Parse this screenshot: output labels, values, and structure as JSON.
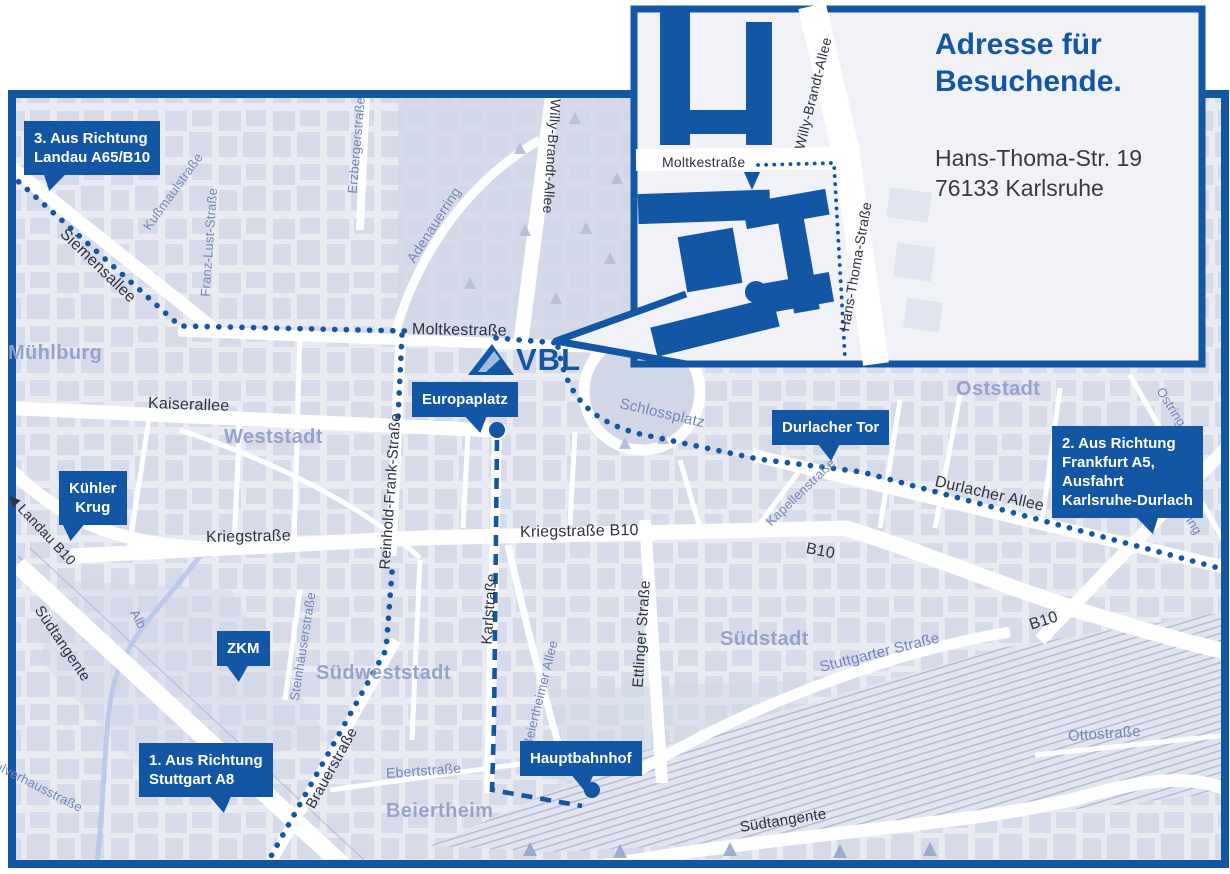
{
  "colors": {
    "primary_blue": "#1356a4",
    "map_bg": "#e9ebf3",
    "block": "#d6dae9",
    "road": "#ffffff",
    "district_text": "#93a0ca",
    "street_dark": "#2e3340",
    "street_minor": "#7386ba",
    "rail": "#a9b2d2",
    "river": "#b9c7e7",
    "park": "#d2d7e8",
    "logo_stripe": "#9dbede",
    "text_dark": "#3a3a3a",
    "inset_bg": "#f1f2f7"
  },
  "inset": {
    "title_line1": "Adresse für",
    "title_line2": "Besuchende.",
    "address_line1": "Hans-Thoma-Str. 19",
    "address_line2": "76133 Karlsruhe"
  },
  "logo": {
    "text": "VBL"
  },
  "map": {
    "street_labels": [
      {
        "id": "siemensallee",
        "text": "Siemensallee",
        "x": 62,
        "y": 232,
        "rot": 44,
        "size": 16,
        "minor": false
      },
      {
        "id": "moltkestrasse",
        "text": "Moltkestraße",
        "x": 412,
        "y": 330,
        "rot": 1,
        "size": 16,
        "minor": false
      },
      {
        "id": "kaiserallee",
        "text": "Kaiserallee",
        "x": 148,
        "y": 404,
        "rot": 2,
        "size": 16,
        "minor": false
      },
      {
        "id": "kriegstrasse",
        "text": "Kriegstraße",
        "x": 206,
        "y": 538,
        "rot": -1,
        "size": 16,
        "minor": false
      },
      {
        "id": "kriegstrasse-b10",
        "text": "Kriegstraße B10",
        "x": 520,
        "y": 533,
        "rot": -1,
        "size": 16,
        "minor": false
      },
      {
        "id": "willy-brandt-allee",
        "text": "Willy-Brandt-Allee",
        "x": 556,
        "y": 100,
        "rot": 94,
        "size": 14,
        "minor": false
      },
      {
        "id": "erzbergerstrasse",
        "text": "Erzbergerstraße",
        "x": 352,
        "y": 195,
        "rot": -85,
        "size": 13,
        "minor": true
      },
      {
        "id": "kussmaulstrasse",
        "text": "Kußmaulstraße",
        "x": 146,
        "y": 230,
        "rot": -54,
        "size": 13,
        "minor": true
      },
      {
        "id": "franz-lust-strasse",
        "text": "Franz-Lust-Straße",
        "x": 205,
        "y": 298,
        "rot": -86,
        "size": 13,
        "minor": true
      },
      {
        "id": "adenauerring",
        "text": "Adenauerring",
        "x": 410,
        "y": 262,
        "rot": -57,
        "size": 14,
        "minor": true
      },
      {
        "id": "schlossplatz",
        "text": "Schlossplatz",
        "x": 620,
        "y": 404,
        "rot": 13,
        "size": 15,
        "minor": true
      },
      {
        "id": "durlacher-allee",
        "text": "Durlacher Allee",
        "x": 935,
        "y": 482,
        "rot": 13,
        "size": 16,
        "minor": false
      },
      {
        "id": "kapellenstrasse",
        "text": "Kapellenstraße",
        "x": 768,
        "y": 525,
        "rot": -44,
        "size": 13,
        "minor": true
      },
      {
        "id": "b10-west",
        "text": "B10",
        "x": 806,
        "y": 549,
        "rot": 11,
        "size": 16,
        "minor": false
      },
      {
        "id": "b10-east",
        "text": "B10",
        "x": 1030,
        "y": 626,
        "rot": -18,
        "size": 16,
        "minor": false
      },
      {
        "id": "ostring-north",
        "text": "Ostring",
        "x": 1160,
        "y": 390,
        "rot": 58,
        "size": 13,
        "minor": true
      },
      {
        "id": "ostring-south",
        "text": "Ostring",
        "x": 1176,
        "y": 498,
        "rot": 58,
        "size": 13,
        "minor": true
      },
      {
        "id": "stuttgarter-strasse",
        "text": "Stuttgarter Straße",
        "x": 820,
        "y": 668,
        "rot": -14,
        "size": 15,
        "minor": true
      },
      {
        "id": "steinhaeuserstrasse",
        "text": "Steinhäuserstraße",
        "x": 294,
        "y": 702,
        "rot": -81,
        "size": 13,
        "minor": true
      },
      {
        "id": "brauerstrasse",
        "text": "Brauerstraße",
        "x": 310,
        "y": 808,
        "rot": -61,
        "size": 15,
        "minor": false
      },
      {
        "id": "ebertstrasse",
        "text": "Ebertstraße",
        "x": 386,
        "y": 774,
        "rot": -4,
        "size": 14,
        "minor": true
      },
      {
        "id": "beiertheimer-allee",
        "text": "Beiertheimer Allee",
        "x": 527,
        "y": 748,
        "rot": -76,
        "size": 13,
        "minor": true
      },
      {
        "id": "ettlinger-strasse",
        "text": "Ettlinger Straße",
        "x": 638,
        "y": 688,
        "rot": -86,
        "size": 15,
        "minor": false
      },
      {
        "id": "karlstrasse",
        "text": "Karlstraße",
        "x": 487,
        "y": 645,
        "rot": -86,
        "size": 15,
        "minor": false
      },
      {
        "id": "reinhold-frank-strasse",
        "text": "Reinhold-Frank-Straße",
        "x": 385,
        "y": 570,
        "rot": -86,
        "size": 15,
        "minor": false
      },
      {
        "id": "suedtangente-west",
        "text": "Südtangente",
        "x": 38,
        "y": 608,
        "rot": 56,
        "size": 15,
        "minor": false
      },
      {
        "id": "suedtangente-sued",
        "text": "Südtangente",
        "x": 740,
        "y": 828,
        "rot": -9,
        "size": 15,
        "minor": false
      },
      {
        "id": "pulverhausstrasse",
        "text": "Pulverhausstraße",
        "x": -12,
        "y": 762,
        "rot": 27,
        "size": 13,
        "minor": true
      },
      {
        "id": "ottostrasse",
        "text": "Ottostraße",
        "x": 1068,
        "y": 737,
        "rot": -4,
        "size": 15,
        "minor": true
      },
      {
        "id": "alb-river",
        "text": "Alb",
        "x": 134,
        "y": 612,
        "rot": 62,
        "size": 13,
        "minor": true
      },
      {
        "id": "landau-b10",
        "text": "◀ Landau B10",
        "x": 10,
        "y": 496,
        "rot": 47,
        "size": 14,
        "minor": false
      },
      {
        "id": "moltkestrasse-inset",
        "text": "Moltkestraße",
        "x": 662,
        "y": 163,
        "rot": 0,
        "size": 14,
        "minor": false
      },
      {
        "id": "willy-brandt-allee-inset",
        "text": "Willy-Brandt-Allee",
        "x": 799,
        "y": 150,
        "rot": -76,
        "size": 14,
        "minor": false
      },
      {
        "id": "hans-thoma-strasse-inset",
        "text": "Hans-Thoma-Straße",
        "x": 844,
        "y": 332,
        "rot": -80,
        "size": 14,
        "minor": false
      }
    ],
    "district_labels": [
      {
        "id": "muehlburg",
        "text": "Mühlburg",
        "x": 8,
        "y": 342
      },
      {
        "id": "weststadt",
        "text": "Weststadt",
        "x": 224,
        "y": 426
      },
      {
        "id": "oststadt",
        "text": "Oststadt",
        "x": 956,
        "y": 378
      },
      {
        "id": "suedstadt",
        "text": "Südstadt",
        "x": 720,
        "y": 628
      },
      {
        "id": "suedweststadt",
        "text": "Südweststadt",
        "x": 316,
        "y": 662
      },
      {
        "id": "beiertheim",
        "text": "Beiertheim",
        "x": 386,
        "y": 800
      }
    ],
    "callouts": [
      {
        "id": "landau",
        "lines": [
          "3. Aus Richtung",
          "Landau A65/B10"
        ],
        "x": 24,
        "y": 121,
        "pointer_x": 52,
        "skew": -18,
        "center": false
      },
      {
        "id": "kuehler-krug",
        "lines": [
          "Kühler",
          "Krug"
        ],
        "x": 59,
        "y": 471,
        "pointer_x": 72,
        "skew": -10,
        "center": true
      },
      {
        "id": "zkm",
        "lines": [
          "ZKM"
        ],
        "x": 217,
        "y": 631,
        "pointer_x": 238,
        "skew": 5,
        "center": true
      },
      {
        "id": "europaplatz",
        "lines": [
          "Europaplatz"
        ],
        "x": 412,
        "y": 382,
        "pointer_x": 478,
        "skew": 15,
        "center": false
      },
      {
        "id": "durlacher-tor",
        "lines": [
          "Durlacher Tor"
        ],
        "x": 772,
        "y": 410,
        "pointer_x": 830,
        "skew": 8,
        "center": false
      },
      {
        "id": "frankfurt",
        "lines": [
          "2. Aus Richtung",
          "Frankfurt A5,",
          "Ausfahrt",
          "Karlsruhe-Durlach"
        ],
        "x": 1052,
        "y": 426,
        "pointer_x": 1150,
        "skew": 18,
        "center": false
      },
      {
        "id": "stuttgart",
        "lines": [
          "1. Aus Richtung",
          "Stuttgart A8"
        ],
        "x": 139,
        "y": 743,
        "pointer_x": 222,
        "skew": 12,
        "center": false
      },
      {
        "id": "hauptbahnhof",
        "lines": [
          "Hauptbahnhof"
        ],
        "x": 520,
        "y": 741,
        "pointer_x": 584,
        "skew": 10,
        "center": false
      }
    ],
    "routes": [
      {
        "id": "route-from-landau",
        "style": "dotted",
        "layer": "map",
        "d": "M10 174 L180 326 L408 331"
      },
      {
        "id": "route-moltkestrasse-to-vbl",
        "style": "dotted",
        "layer": "map",
        "d": "M496 338 L557 343"
      },
      {
        "id": "route-from-stuttgart",
        "style": "dotted",
        "layer": "map",
        "d": "M402 335 L398 418 M392 572 L386 650 L270 858"
      },
      {
        "id": "route-from-frankfurt",
        "style": "dotted",
        "layer": "map",
        "d": "M558 347 C566 392 586 420 640 434 L758 459 L862 472 L1226 570"
      },
      {
        "id": "route-tram-karlstrasse",
        "style": "dashed",
        "layer": "map",
        "d": "M497 440 L494 724 L492 790 L582 806"
      },
      {
        "id": "route-inset-moltkestrasse",
        "style": "dotted-small",
        "layer": "inset",
        "d": "M758 165 L834 163 L845 358"
      }
    ],
    "stations": [
      {
        "id": "europaplatz-stop",
        "x": 497,
        "y": 430
      },
      {
        "id": "hauptbahnhof-stop",
        "x": 592,
        "y": 790
      }
    ]
  }
}
